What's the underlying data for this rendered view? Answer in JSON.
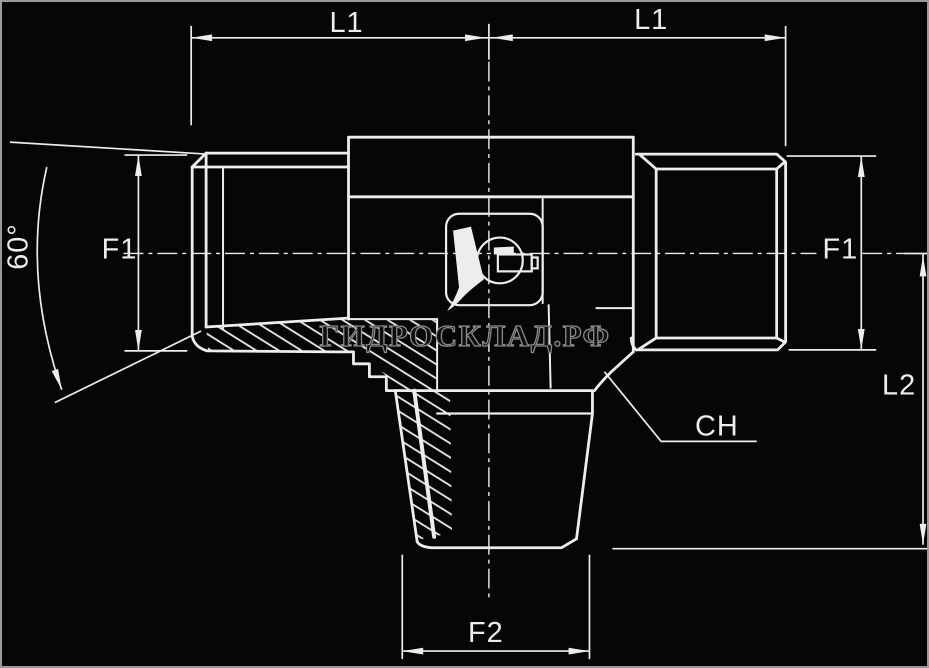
{
  "drawing": {
    "kind": "tee fitting technical drawing",
    "labels": {
      "l1_left": "L1",
      "l1_right": "L1",
      "f1_left": "F1",
      "f1_right": "F1",
      "l2": "L2",
      "f2": "F2",
      "ch": "CH",
      "cone_angle": "60°"
    },
    "watermark": {
      "text": "ГИДРОСКЛАД.РФ"
    }
  },
  "colors": {
    "background": "#060606",
    "border": "#9a9a9a",
    "line": "#ededed",
    "watermark_stroke": "#8a8a8a",
    "watermark_fill": "#0d0d0d"
  }
}
